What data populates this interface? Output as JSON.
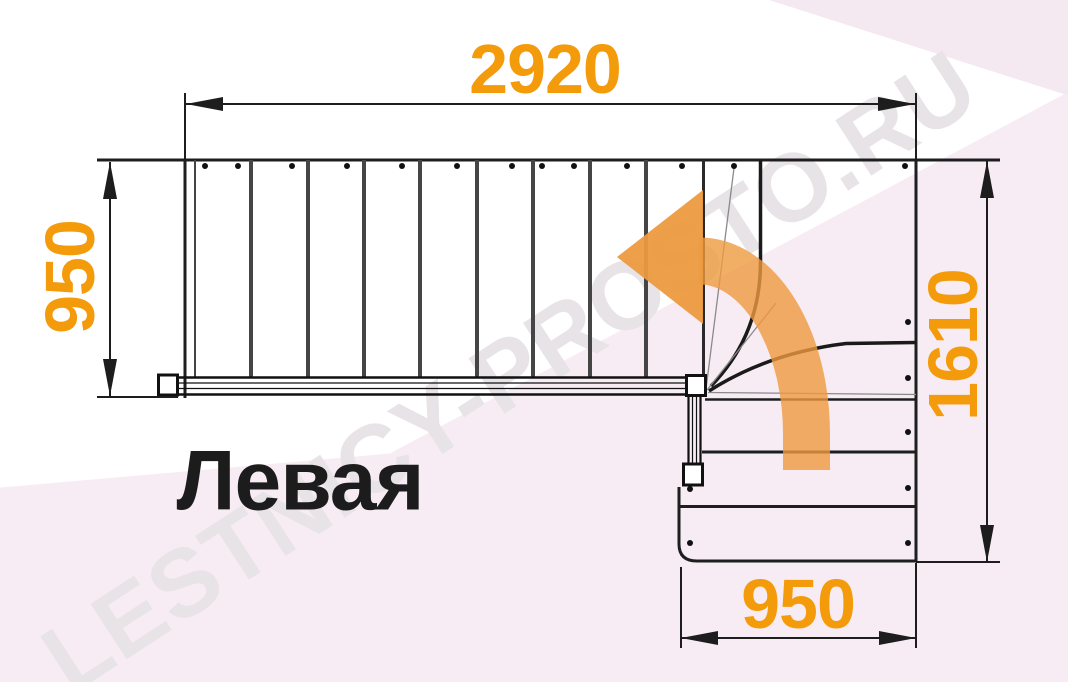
{
  "diagram": {
    "label": "Левая",
    "watermark": "LESTNICY-PROSTO.RU",
    "dimensions": {
      "top": "2920",
      "left": "950",
      "right": "1610",
      "bottom": "950"
    },
    "colors": {
      "dimension_text": "#F49B0B",
      "arrow": "#ED9A3F",
      "line": "#1D1D1D",
      "label": "#1C1C1C",
      "watermark": "#E7E3E6",
      "background_pink": "#F7ECF3"
    }
  }
}
